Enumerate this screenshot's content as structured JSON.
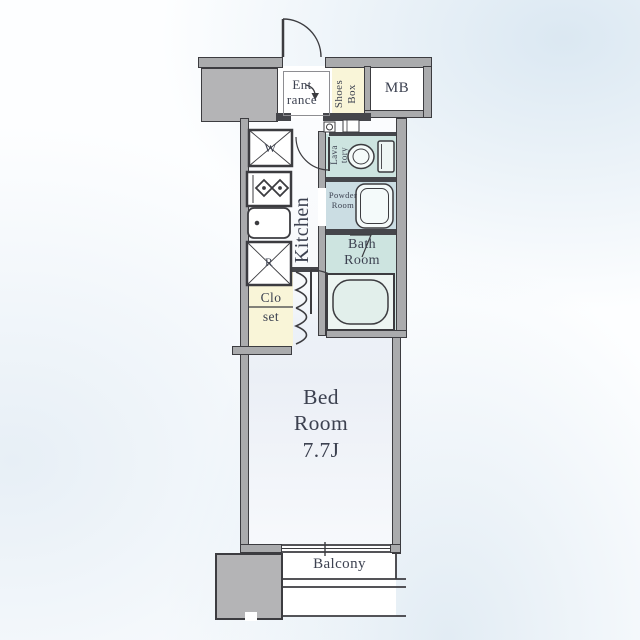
{
  "labels": {
    "entrance": {
      "line1": "Ent",
      "line2": "rance"
    },
    "shoes_box": {
      "line1": "Shoes",
      "line2": "Box"
    },
    "meter_box": {
      "text": "MB"
    },
    "washer": {
      "text": "W"
    },
    "refrigerator": {
      "text": "R"
    },
    "kitchen": {
      "text": "Kitchen"
    },
    "lavatory": {
      "line1": "Lava",
      "line2": "tory"
    },
    "powder_room": {
      "line1": "Powder",
      "line2": "Room"
    },
    "bath_room": {
      "line1": "Bath",
      "line2": "Room"
    },
    "closet": {
      "line1": "Clo",
      "line2": "set"
    },
    "bed_room": {
      "line1": "Bed",
      "line2": "Room",
      "line3": "7.7J"
    },
    "balcony": {
      "text": "Balcony"
    }
  },
  "colors": {
    "wall_fill": "#aaabad",
    "wall_line": "#3c3c40",
    "wet_area_teal": "#cde4e0",
    "powder_area": "#cbdde3",
    "storage_yellow": "#f9f5d8",
    "bedroom_tint": "#ecf0f7",
    "text": "#3c4150",
    "background_wash": "#dbe8f2"
  }
}
